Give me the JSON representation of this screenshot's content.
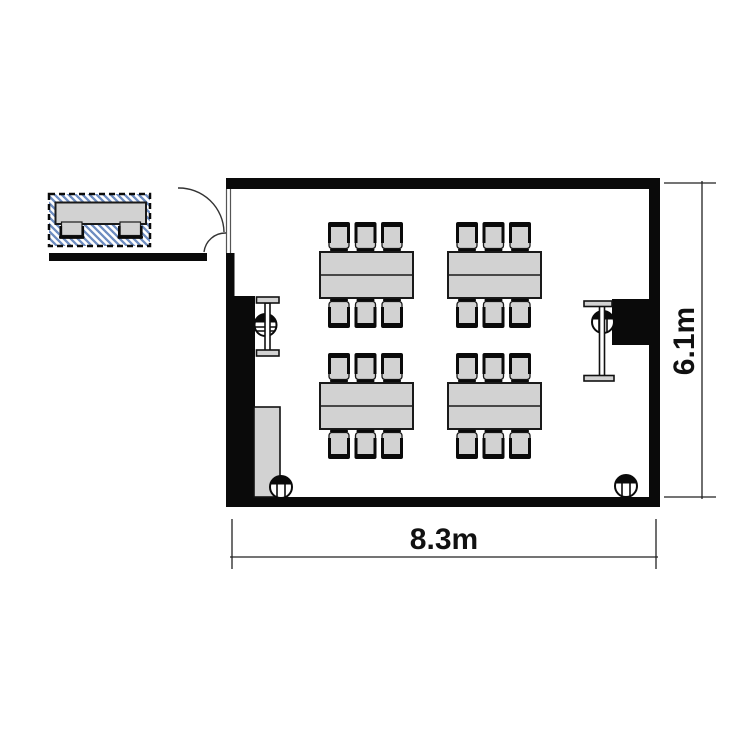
{
  "diagram": {
    "type": "floor-plan",
    "dimensions": {
      "width_label": "8.3m",
      "height_label": "6.1m"
    },
    "furniture": {
      "table_groups": 4,
      "seats_per_group": 6,
      "total_seats": 24,
      "external_tables": 1,
      "external_chairs": 2,
      "column_symbols": 4,
      "presenter_stands": 2
    },
    "colors": {
      "wall": "#0a0a0a",
      "furniture_fill": "#d2d2d2",
      "furniture_outline": "#1a1a1a",
      "hatch_line": "#6d8cc0",
      "dimension_line": "#222222",
      "label_text": "#111111"
    }
  }
}
